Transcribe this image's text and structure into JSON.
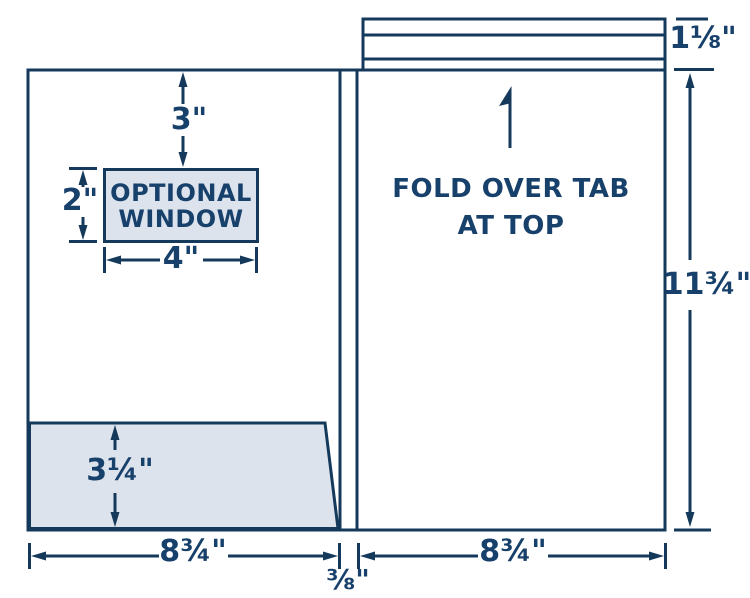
{
  "colors": {
    "line": "#14395B",
    "text": "#17406B",
    "shade_fill": "#DCE3ED",
    "panel_fill": "#FFFFFF",
    "background": "#FFFFFF"
  },
  "diagram": {
    "left_panel": {
      "window_offset_label": "3\"",
      "window": {
        "line1": "OPTIONAL",
        "line2": "WINDOW",
        "height_label": "2\"",
        "width_label": "4\""
      },
      "pocket_height_label": "3¼\"",
      "width_label": "8¾\""
    },
    "spine": {
      "width_label": "⅜\""
    },
    "right_panel": {
      "note_line1": "FOLD OVER TAB",
      "note_line2": "AT TOP",
      "width_label": "8¾\"",
      "height_label": "11¾\"",
      "tab_height_label": "1⅛\""
    }
  }
}
